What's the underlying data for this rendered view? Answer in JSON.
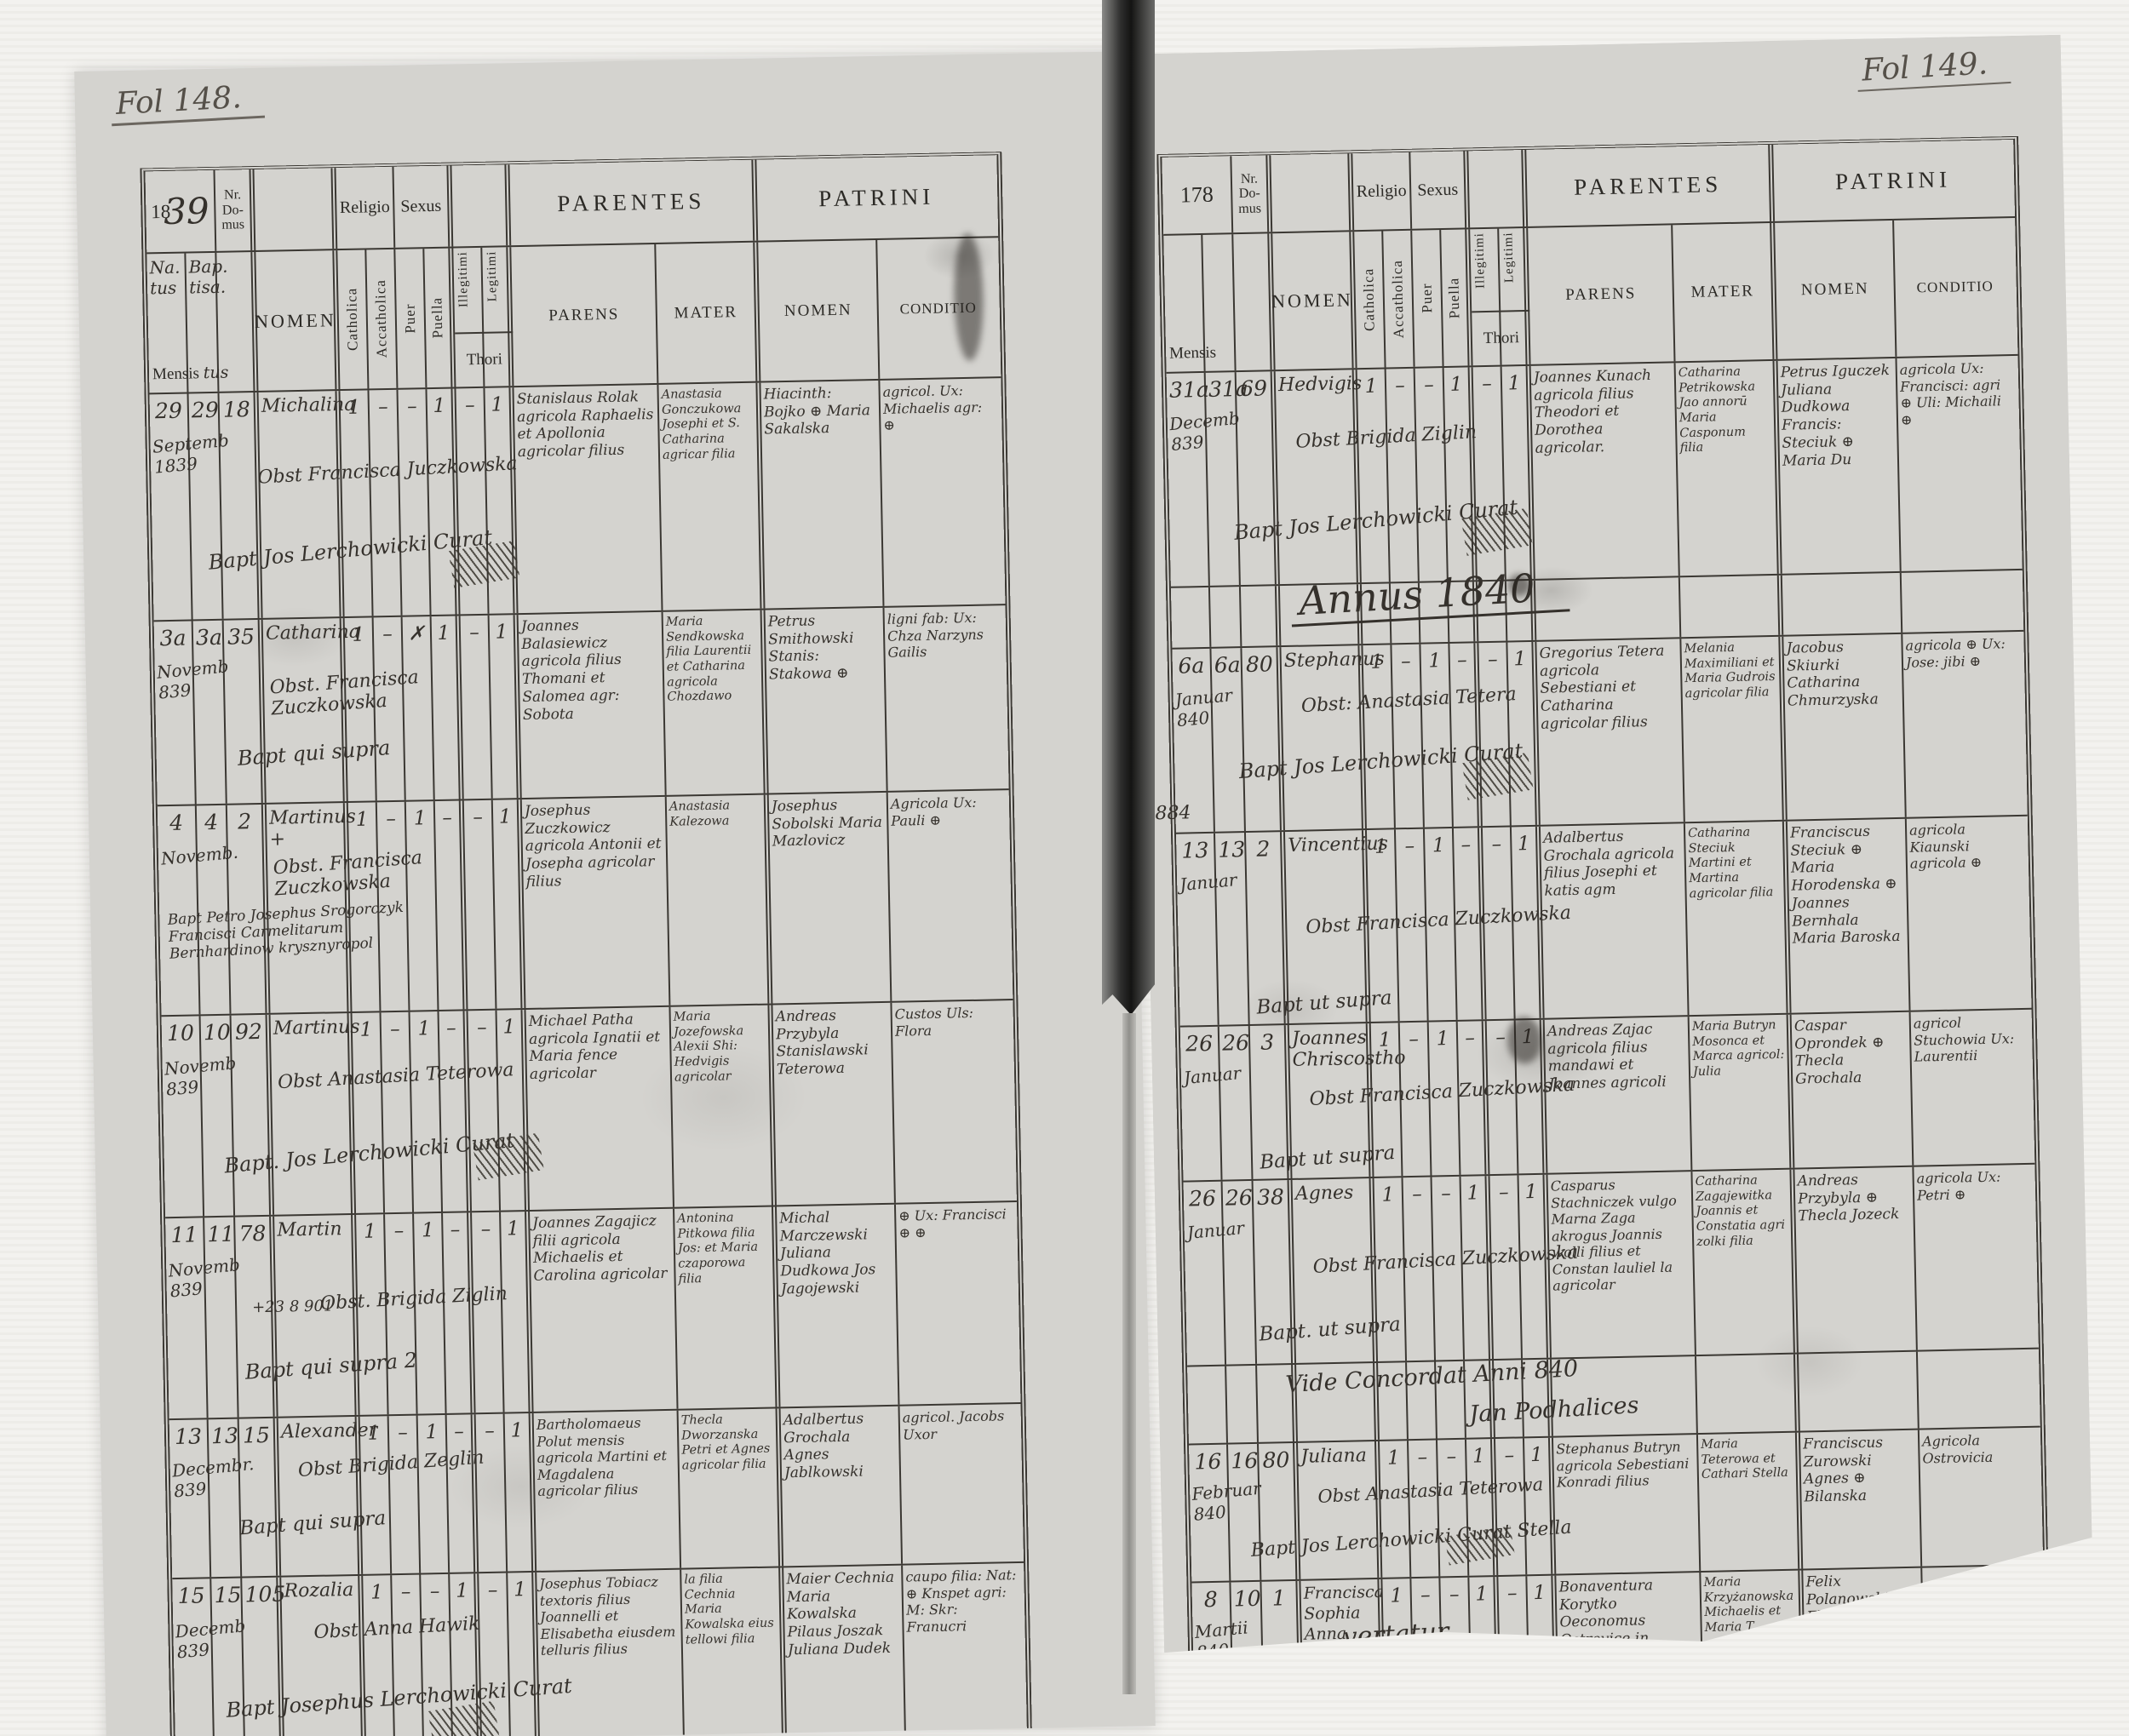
{
  "scan": {
    "folio_left": "Fol 148.",
    "folio_right": "Fol 149."
  },
  "hdr": {
    "year_left_printed": "18",
    "year_left_script": "39",
    "year_right": "178",
    "nr_domus": "Nr. Do- mus",
    "religio": "Religio",
    "sexus": "Sexus",
    "parentes": "PARENTES",
    "patrini": "PATRINI",
    "natus_hw": "Na. tus",
    "baptisa_hw": "Bap. tisa.",
    "mensis": "Mensis",
    "mensis_hw": "tus",
    "nomen": "NOMEN",
    "catholica": "Catholica",
    "acatholica": "Accatholica",
    "puer": "Puer",
    "puella": "Puella",
    "illegitimi": "Illegitimi",
    "legitimi": "Legitimi",
    "thori": "Thori",
    "parens": "PARENS",
    "mater": "MATER",
    "patrini_nomen": "NOMEN",
    "conditio": "CONDITIO"
  },
  "left_page": {
    "rows": [
      {
        "natus": "29",
        "bapt": "29",
        "domus": "18",
        "month": "Septemb 1839",
        "nomen": "Michalina",
        "obst": "Obst Francisca Juczkowska",
        "baptline": "Bapt Jos Lerchowicki Curat",
        "cath": "1",
        "acath": "–",
        "puer": "–",
        "puella": "1",
        "illeg": "–",
        "legit": "1",
        "parens": "Stanislaus Rolak agricola Raphaelis et Apollonia agricolar filius",
        "mater": "Anastasia Gonczukowa Josephi et S. Catharina agricar filia",
        "patrini": "Hiacinth: Bojko ⊕ Maria Sakalska",
        "conditio": "agricol. Ux: Michaelis agr: ⊕"
      },
      {
        "natus": "3a",
        "bapt": "3a",
        "domus": "35",
        "month": "Novemb 839",
        "nomen": "Catharina",
        "obst": "Obst. Francisca Zuczkowska",
        "baptline": "Bapt qui supra",
        "cath": "1",
        "acath": "–",
        "puer": "✗",
        "puella": "1",
        "illeg": "–",
        "legit": "1",
        "parens": "Joannes Balasiewicz agricola filius Thomani et Salomea agr: Sobota",
        "mater": "Maria Sendkowska filia Laurentii et Catharina agricola Chozdawo",
        "patrini": "Petrus Smithowski Stanis: Stakowa ⊕",
        "conditio": "ligni fab: Ux: Chza Narzyns Gailis"
      },
      {
        "natus": "4",
        "bapt": "4",
        "domus": "2",
        "month": "Novemb.",
        "nomen": "Martinus +",
        "obst": "Obst. Francisca Zuczkowska",
        "baptline": "Bapt Petro Josephus Srogorczyk Francisci Carmelitarum Bernhardinow krysznyropol",
        "cath": "1",
        "acath": "–",
        "puer": "1",
        "puella": "–",
        "illeg": "–",
        "legit": "1",
        "parens": "Josephus Zuczkowicz agricola Antonii et Josepha agricolar filius",
        "mater": "Anastasia Kalezowa",
        "patrini": "Josephus Sobolski Maria Mazlovicz",
        "conditio": "Agricola Ux: Pauli ⊕"
      },
      {
        "natus": "10",
        "bapt": "10",
        "domus": "92",
        "month": "Novemb 839",
        "nomen": "Martinus",
        "obst": "Obst Anastasia Teterowa",
        "baptline": "Bapt. Jos Lerchowicki Curat",
        "cath": "1",
        "acath": "–",
        "puer": "1",
        "puella": "–",
        "illeg": "–",
        "legit": "1",
        "parens": "Michael Patha agricola Ignatii et Maria fence agricolar",
        "mater": "Maria Jozefowska Alexii Shi: Hedvigis agricolar",
        "patrini": "Andreas Przybyla Stanislawski Teterowa",
        "conditio": "Custos Uls: Flora"
      },
      {
        "natus": "11",
        "bapt": "11",
        "domus": "78",
        "month": "Novemb 839",
        "nomen": "Martin",
        "note": "+23 8 901",
        "obst": "Obst. Brigida Ziglin",
        "baptline": "Bapt qui supra 2",
        "cath": "1",
        "acath": "–",
        "puer": "1",
        "puella": "–",
        "illeg": "–",
        "legit": "1",
        "parens": "Joannes Zagajicz filii agricola Michaelis et Carolina agricolar",
        "mater": "Antonina Pitkowa filia Jos: et Maria czaporowa filia",
        "patrini": "Michal Marczewski Juliana Dudkowa Jos Jagojewski",
        "conditio": "⊕ Ux: Francisci ⊕ ⊕"
      },
      {
        "natus": "13",
        "bapt": "13",
        "domus": "15",
        "month": "Decembr. 839",
        "nomen": "Alexander",
        "obst": "Obst Brigida Zeglin",
        "baptline": "Bapt qui supra",
        "cath": "1",
        "acath": "–",
        "puer": "1",
        "puella": "–",
        "illeg": "–",
        "legit": "1",
        "parens": "Bartholomaeus Polut mensis agricola Martini et Magdalena agricolar filius",
        "mater": "Thecla Dworzanska Petri et Agnes agricolar filia",
        "patrini": "Adalbertus Grochala Agnes Jablkowski",
        "conditio": "agricol. Jacobs Uxor"
      },
      {
        "natus": "15",
        "bapt": "15",
        "domus": "105",
        "month": "Decemb 839",
        "nomen": "Rozalia",
        "obst": "Obst Anna Hawik",
        "baptline": "Bapt Josephus Lerchowicki Curat",
        "cath": "1",
        "acath": "–",
        "puer": "–",
        "puella": "1",
        "illeg": "–",
        "legit": "1",
        "parens": "Josephus Tobiacz textoris filius Joannelli et Elisabetha eiusdem telluris filius",
        "mater": "la filia Cechnia Maria Kowalska eius tellowi filia",
        "patrini": "Maier Cechnia Maria Kowalska Pilaus Joszak Juliana Dudek",
        "conditio": "caupo filia: Nat: ⊕ Knspet agri: M: Skr: Franucri"
      }
    ]
  },
  "right_page": {
    "annus": "Annus 1840",
    "note1": "Vide Concordat Anni 840",
    "note2": "Jan Podhalices",
    "margin_note": "884",
    "vertatur": "vertatur",
    "rows": [
      {
        "natus": "31a",
        "bapt": "31a",
        "domus": "69",
        "month": "Decemb 839",
        "nomen": "Hedvigis",
        "obst": "Obst Brigida Ziglin",
        "baptline": "Bapt Jos Lerchowicki Curat",
        "cath": "1",
        "acath": "–",
        "puer": "–",
        "puella": "1",
        "illeg": "–",
        "legit": "1",
        "parens": "Joannes Kunach agricola filius Theodori et Dorothea agricolar.",
        "mater": "Catharina Petrikowska Jao annorū Maria Casponum filia",
        "patrini": "Petrus Iguczek Juliana Dudkowa Francis: Steciuk ⊕ Maria Du",
        "conditio": "agricola Ux: Francisci: agri ⊕ Uli: Michaili ⊕"
      },
      {
        "natus": "6a",
        "bapt": "6a",
        "domus": "80",
        "month": "Januar 840",
        "nomen": "Stephanus",
        "obst": "Obst: Anastasia Tetera",
        "baptline": "Bapt Jos Lerchowicki Curat",
        "cath": "1",
        "acath": "–",
        "puer": "1",
        "puella": "–",
        "illeg": "–",
        "legit": "1",
        "parens": "Gregorius Tetera agricola Sebestiani et Catharina agricolar filius",
        "mater": "Melania Maximiliani et Maria Gudrois agricolar filia",
        "patrini": "Jacobus Skiurki Catharina Chmurzyska",
        "conditio": "agricola ⊕ Ux: Jose: jibi ⊕"
      },
      {
        "natus": "13",
        "bapt": "13",
        "domus": "2",
        "month": "Januar",
        "nomen": "Vincentius",
        "obst": "Obst Francisca Zuczkowska",
        "baptline": "Bapt ut supra",
        "cath": "1",
        "acath": "–",
        "puer": "1",
        "puella": "–",
        "illeg": "–",
        "legit": "1",
        "parens": "Adalbertus Grochala agricola filius Josephi et katis agm",
        "mater": "Catharina Steciuk Martini et Martina agricolar filia",
        "patrini": "Franciscus Steciuk ⊕ Maria Horodenska ⊕ Joannes Bernhala Maria Baroska",
        "conditio": "agricola Kiaunski agricola ⊕"
      },
      {
        "natus": "26",
        "bapt": "26",
        "domus": "3",
        "month": "Januar",
        "nomen": "Joannes Chriscostho",
        "obst": "Obst Francisca Zuczkowska",
        "baptline": "Bapt ut supra",
        "cath": "1",
        "acath": "–",
        "puer": "1",
        "puella": "–",
        "illeg": "–",
        "legit": "1",
        "parens": "Andreas Zajac agricola filius mandawi et Joannes agricoli",
        "mater": "Maria Butryn Mosonca et Marca agricol: Julia",
        "patrini": "Caspar Oprondek ⊕ Thecla Grochala",
        "conditio": "agricol Stuchowia Ux: Laurentii"
      },
      {
        "natus": "26",
        "bapt": "26",
        "domus": "38",
        "month": "Januar",
        "nomen": "Agnes",
        "obst": "Obst Francisca Zuczkowska",
        "baptline": "Bapt. ut supra",
        "cath": "1",
        "acath": "–",
        "puer": "–",
        "puella": "1",
        "illeg": "–",
        "legit": "1",
        "parens": "Casparus Stachniczek vulgo Marna Zaga akrogus Joannis wolli filius et Constan lauliel la agricolar",
        "mater": "Catharina Zagajewitka Joannis et Constatia agri zolki filia",
        "patrini": "Andreas Przybyla ⊕ Thecla Jozeck",
        "conditio": "agricola Ux: Petri ⊕"
      },
      {
        "natus": "16",
        "bapt": "16",
        "domus": "80",
        "month": "Februar 840",
        "nomen": "Juliana",
        "obst": "Obst Anastasia Teterowa",
        "baptline": "Bapt Jos Lerchowicki Curat Stella",
        "cath": "1",
        "acath": "–",
        "puer": "–",
        "puella": "1",
        "illeg": "–",
        "legit": "1",
        "parens": "Stephanus Butryn agricola Sebestiani Konradi filius",
        "mater": "Maria Teterowa et Cathari Stella",
        "patrini": "Franciscus Zurowski Agnes ⊕ Bilanska",
        "conditio": "Agricola Ostrovicia"
      },
      {
        "natus": "8",
        "bapt": "10",
        "domus": "1",
        "month": "Martii 840",
        "nomen": "Francisca Sophia Anna (trinomim) +",
        "obst": "",
        "baptline": "",
        "cath": "1",
        "acath": "–",
        "puer": "–",
        "puella": "1",
        "illeg": "–",
        "legit": "1",
        "parens": "Bonaventura Korytko Oeconomus Ostrovice in Taravica nata",
        "mater": "Maria Krzyżanowska Michaelis et Maria T",
        "patrini": "Felix Polanowski Flamawska Lazezik Wierbij Dariandrowska",
        "conditio": ""
      }
    ]
  }
}
